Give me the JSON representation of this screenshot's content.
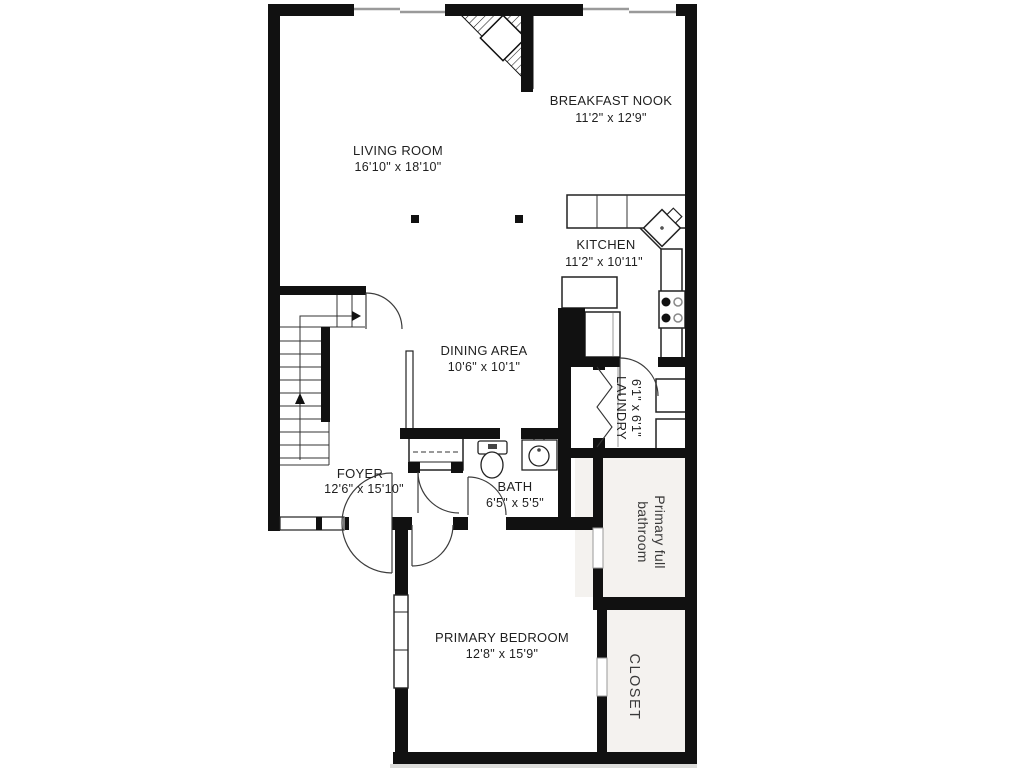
{
  "floorplan": {
    "title": "First floor plan",
    "rooms": {
      "living_room": {
        "name": "LIVING ROOM",
        "dims": "16'10\" x 18'10\""
      },
      "breakfast_nook": {
        "name": "BREAKFAST NOOK",
        "dims": "11'2\" x 12'9\""
      },
      "kitchen": {
        "name": "KITCHEN",
        "dims": "11'2\" x 10'11\""
      },
      "dining_area": {
        "name": "DINING AREA",
        "dims": "10'6\" x 10'1\""
      },
      "laundry": {
        "name": "LAUNDRY",
        "dims": "6'1\" x 6'1\""
      },
      "foyer": {
        "name": "FOYER",
        "dims": "12'6\" x 15'10\""
      },
      "bath": {
        "name": "BATH",
        "dims": "6'5\" x 5'5\""
      },
      "primary_bathroom": {
        "line1": "Primary full",
        "line2": "bathroom"
      },
      "primary_bedroom": {
        "name": "PRIMARY BEDROOM",
        "dims": "12'8\" x 15'9\""
      },
      "closet": {
        "name": "CLOSET"
      }
    },
    "colors": {
      "wall": "#111111",
      "door_arc": "#3c3c3c",
      "window": "#9a9a9a",
      "room_tint": "#f4f2ef"
    }
  }
}
